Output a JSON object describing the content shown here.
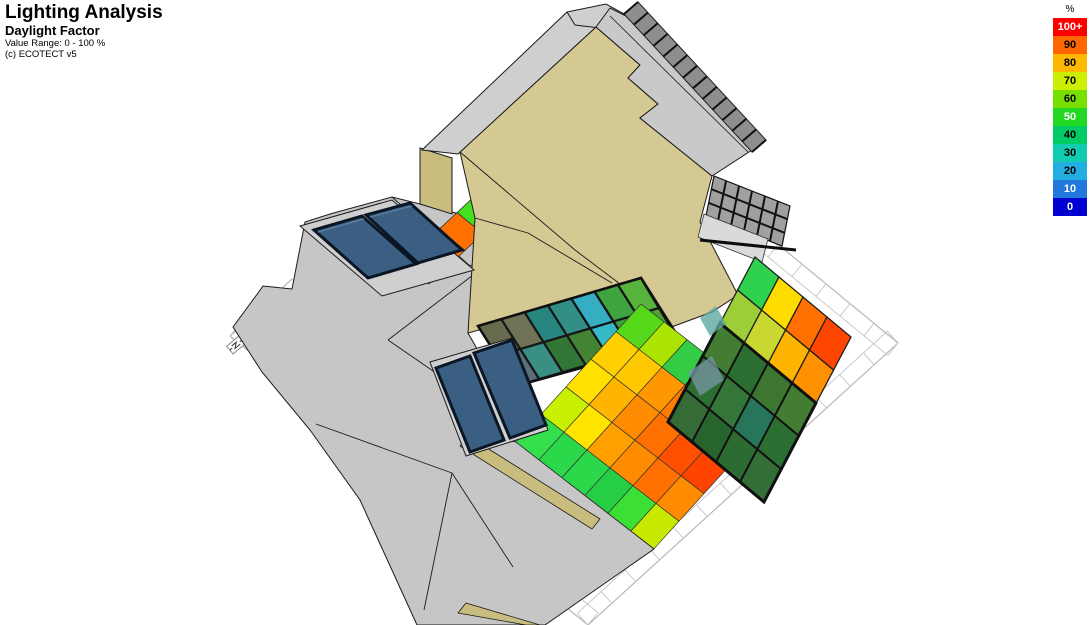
{
  "header": {
    "title": "Lighting Analysis",
    "subtitle": "Daylight Factor",
    "value_range": "Value Range: 0 - 100 %",
    "copyright": "(c) ECOTECT v5"
  },
  "legend": {
    "unit": "%",
    "items": [
      {
        "label": "100+",
        "color": "#FF0000",
        "text_color": "#FFFFFF"
      },
      {
        "label": "90",
        "color": "#FF6600",
        "text_color": "#000000"
      },
      {
        "label": "80",
        "color": "#FFB800",
        "text_color": "#000000"
      },
      {
        "label": "70",
        "color": "#CCEE00",
        "text_color": "#000000"
      },
      {
        "label": "60",
        "color": "#77E000",
        "text_color": "#000000"
      },
      {
        "label": "50",
        "color": "#22D822",
        "text_color": "#FFFFFF"
      },
      {
        "label": "40",
        "color": "#00CC66",
        "text_color": "#000000"
      },
      {
        "label": "30",
        "color": "#11CCB1",
        "text_color": "#000000"
      },
      {
        "label": "20",
        "color": "#22AEE0",
        "text_color": "#000000"
      },
      {
        "label": "10",
        "color": "#2277DD",
        "text_color": "#FFFFFF"
      },
      {
        "label": "0",
        "color": "#0000D0",
        "text_color": "#FFFFFF"
      }
    ]
  },
  "scene": {
    "colors": {
      "roof_grey": "#C6C6C6",
      "roof_grey_light": "#CFCFCF",
      "roof_grey_dark": "#C9C9C9",
      "wall_tan": "#D4C993",
      "wall_tan_dark": "#C9BC7F",
      "panel_blue": "#3A5F82",
      "panel_frame": "#0B1624",
      "louver_grey": "#A0A0A0",
      "hatch_grey": "#8E8E8E",
      "ground_line": "#B8B8B8",
      "outline": "#1A1A1A",
      "glass_tint": "rgba(25,30,35,0.32)"
    },
    "analysis_grids": {
      "nw_strip": {
        "origin": [
          403,
          263
        ],
        "u": [
          26,
          21
        ],
        "v": [
          18,
          -16.8
        ],
        "stroke": "#333333",
        "stroke_width": 0.8,
        "colors": [
          [
            "#FFC800",
            "#FF7800",
            "#FF7000",
            "#44E020"
          ]
        ]
      },
      "atrium_strip": {
        "origin": [
          478,
          326
        ],
        "u": [
          19,
          30
        ],
        "v": [
          23.3,
          -6.9
        ],
        "stroke": "#141414",
        "stroke_width": 2.2,
        "colors": [
          [
            "#8F8F63",
            "#9A9A6E",
            "#2FB9AD",
            "#3EC4B4",
            "#35AEC4",
            "#3FA33F",
            "#57B33B"
          ],
          [
            "#7A95A5",
            "#49C4AE",
            "#3E9F3E",
            "#57B33B",
            "#35B9C4",
            "#3E9F3E",
            "#4FA039"
          ]
        ]
      },
      "courtyard": {
        "origin": [
          516,
          442
        ],
        "u": [
          23,
          17.8
        ],
        "v": [
          25,
          -27.6
        ],
        "stroke": "#333333",
        "stroke_width": 0.7,
        "colors": [
          [
            "#33E04C",
            "#C8F000",
            "#FFE000",
            "#FFD000",
            "#55D81A"
          ],
          [
            "#2BD84A",
            "#FFE400",
            "#FFB400",
            "#FFC800",
            "#AAE400"
          ],
          [
            "#2BD84A",
            "#FFA000",
            "#FF8C00",
            "#FF9800",
            "#33CC44"
          ],
          [
            "#26CE44",
            "#FF8C00",
            "#FF7000",
            "#FF7C00",
            "#BBE000"
          ],
          [
            "#3CE034",
            "#FF7000",
            "#FF5000",
            "#FF5A00",
            "#FF8C00"
          ],
          [
            "#C8E800",
            "#FF8C00",
            "#FF4400",
            "#FF3C00",
            "#FF6000"
          ]
        ]
      },
      "east_block": {
        "origin": [
          668,
          422
        ],
        "u": [
          24,
          20
        ],
        "v": [
          17.4,
          -33
        ],
        "stroke": "#1D1D1D",
        "stroke_width": 1.3,
        "colors": [
          [
            "#418F41",
            "#36953B",
            "#57A83B",
            "#9CCE38",
            "#2FD24F"
          ],
          [
            "#2F8534",
            "#41A041",
            "#36953B",
            "#C8D830",
            "#FFDC00"
          ],
          [
            "#35903A",
            "#2FA074",
            "#4FA039",
            "#FFB400",
            "#FF7000"
          ],
          [
            "#3E9440",
            "#36953B",
            "#57A83B",
            "#FF9000",
            "#FF4600"
          ]
        ]
      }
    },
    "hatch": {
      "p1": [
        624,
        14
      ],
      "p2": [
        752,
        152
      ],
      "band": [
        14,
        -12
      ],
      "count": 13
    },
    "ground": {
      "edges": [
        {
          "p1": [
            230,
            336
          ],
          "p2": [
            588,
            625
          ],
          "n": [
            10,
            -12.5
          ],
          "ticks": 15
        },
        {
          "p1": [
            588,
            625
          ],
          "p2": [
            898,
            343
          ],
          "n": [
            -10.7,
            -11.8
          ],
          "ticks": 13
        },
        {
          "p1": [
            898,
            343
          ],
          "p2": [
            730,
            205
          ],
          "n": [
            -10,
            12.5
          ],
          "ticks": 7
        },
        {
          "p1": [
            230,
            336
          ],
          "p2": [
            292,
            279
          ],
          "n": [
            10.7,
            11.8
          ],
          "ticks": 3
        }
      ]
    }
  }
}
